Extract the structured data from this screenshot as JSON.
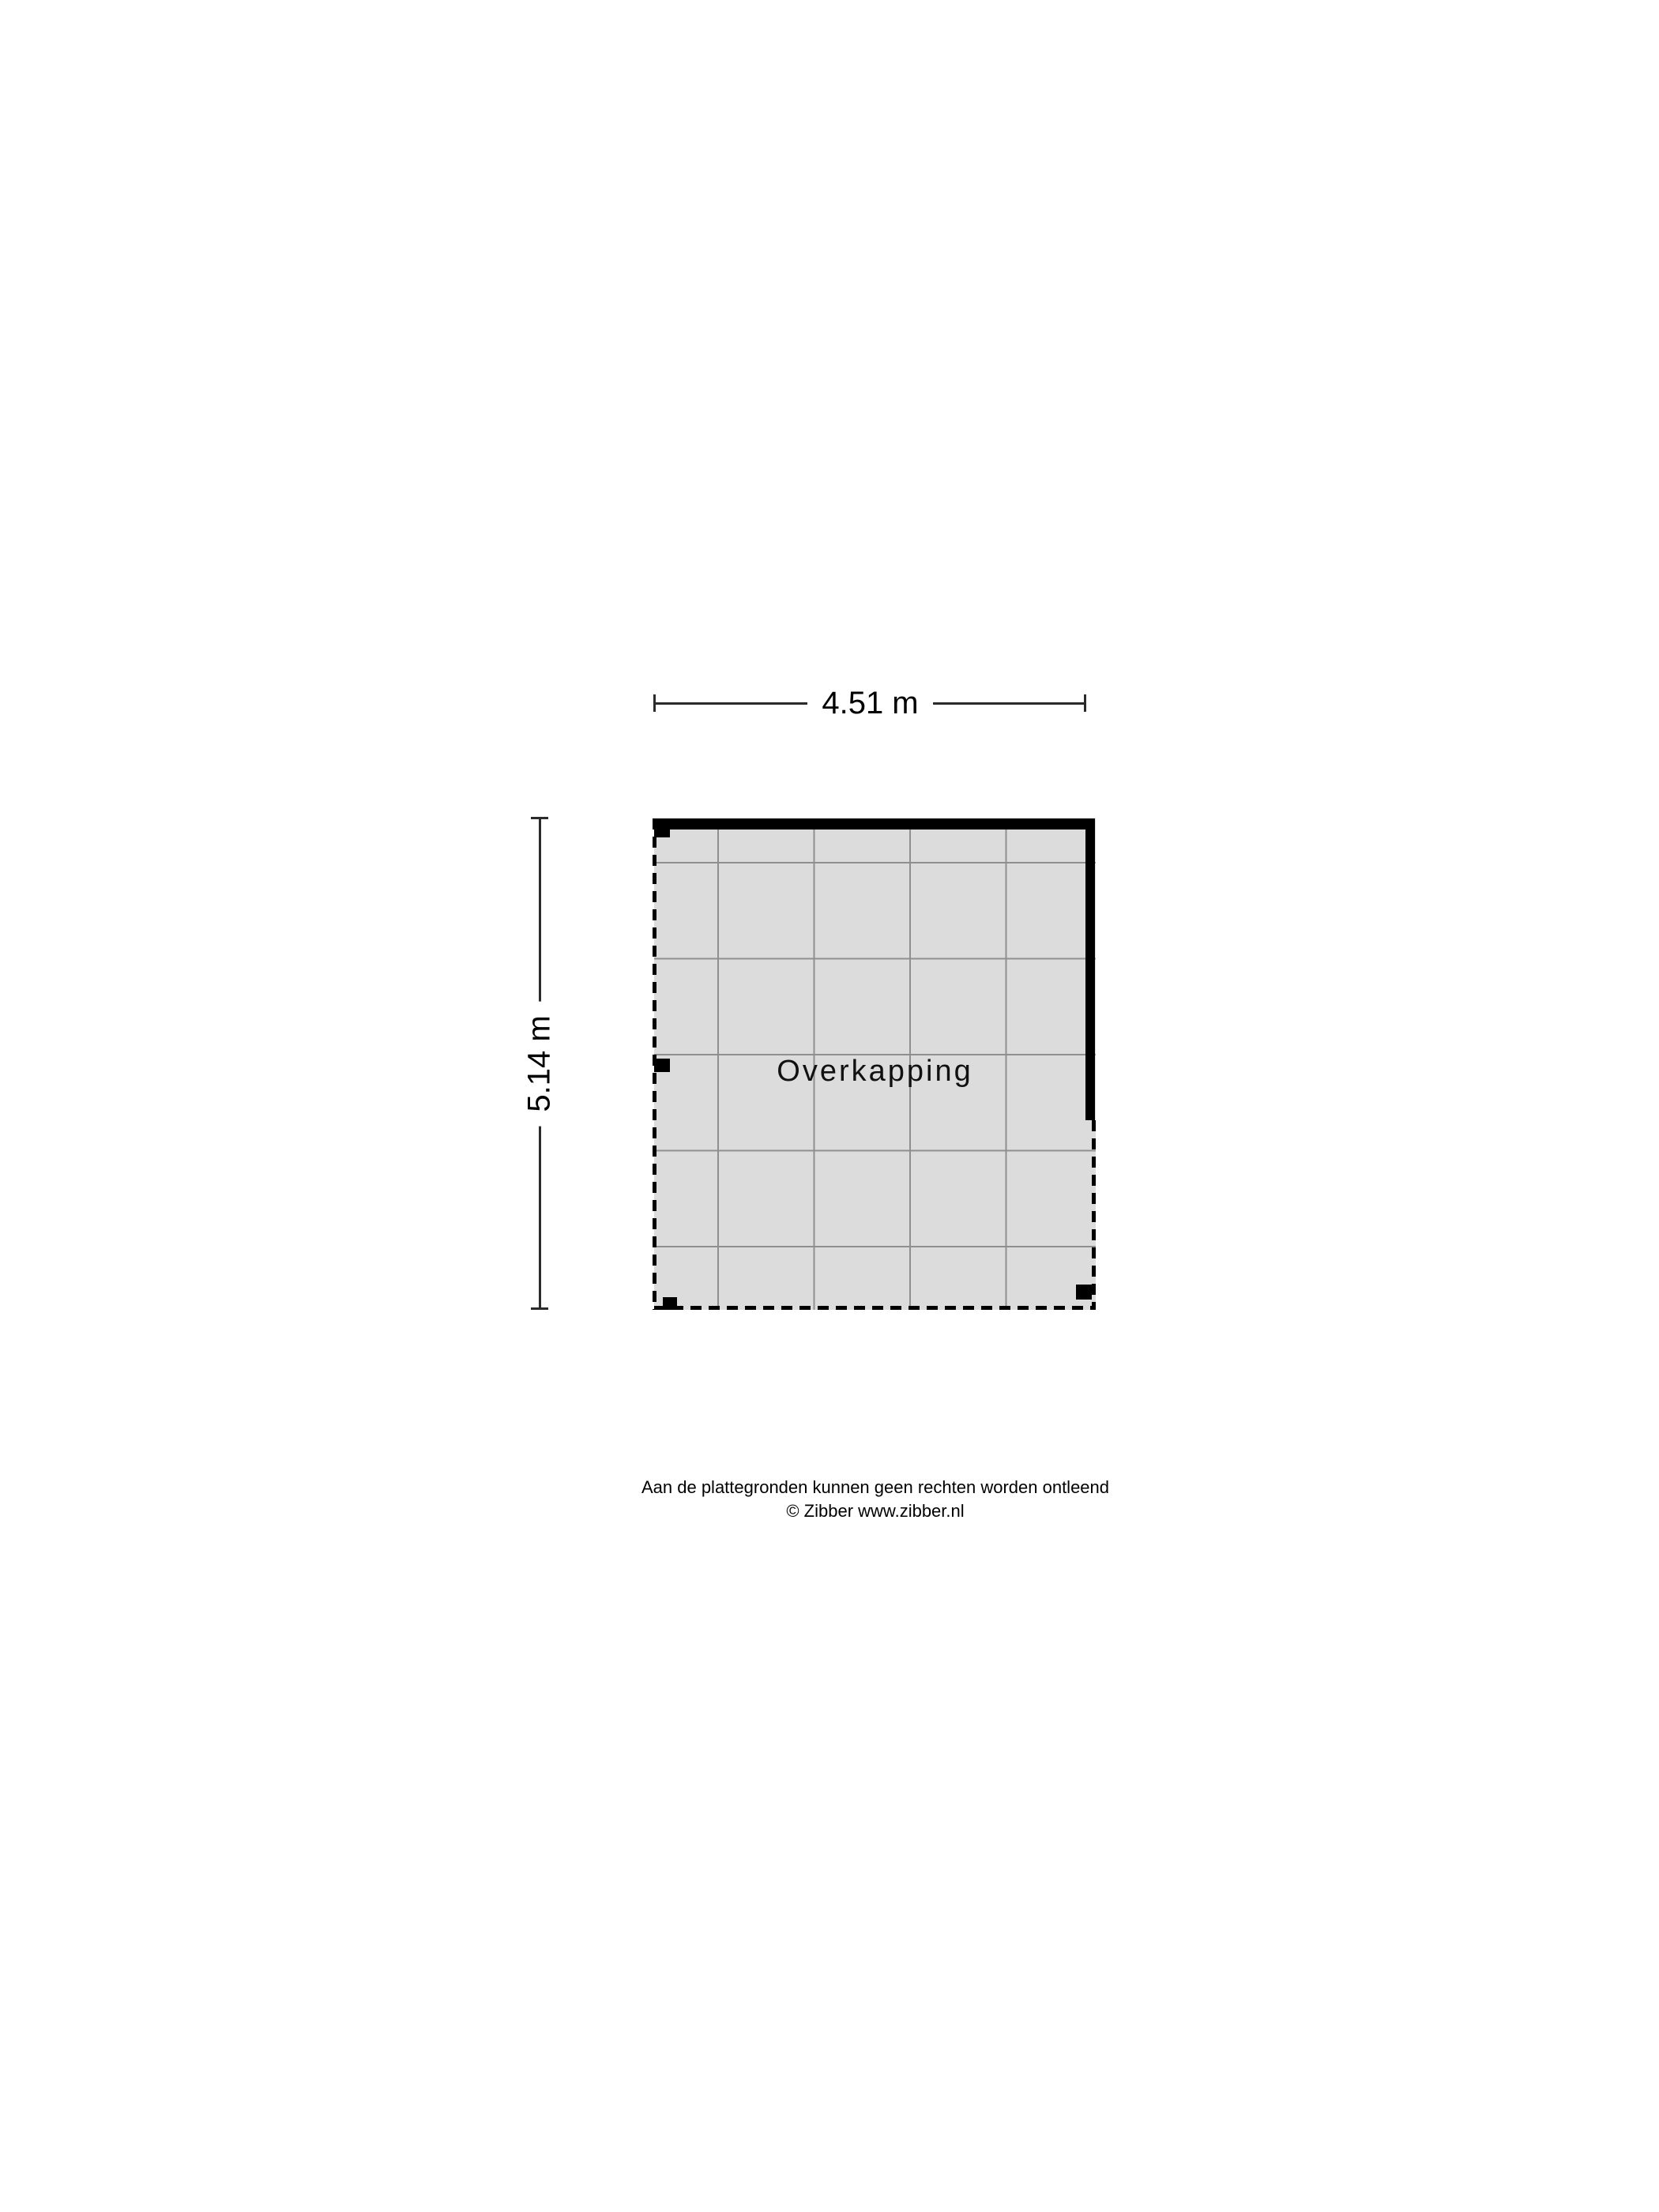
{
  "floorplan": {
    "room": {
      "label": "Overkapping"
    },
    "dimensions": {
      "width_label": "4.51 m",
      "height_label": "5.14 m"
    },
    "colors": {
      "floor_fill": "#dcdcdc",
      "grid_line": "#8f8f8f",
      "wall": "#000000",
      "dimension_line": "#2b2b2b"
    }
  },
  "footer": {
    "disclaimer": "Aan de plattegronden kunnen geen rechten worden ontleend",
    "copyright": "© Zibber www.zibber.nl"
  }
}
